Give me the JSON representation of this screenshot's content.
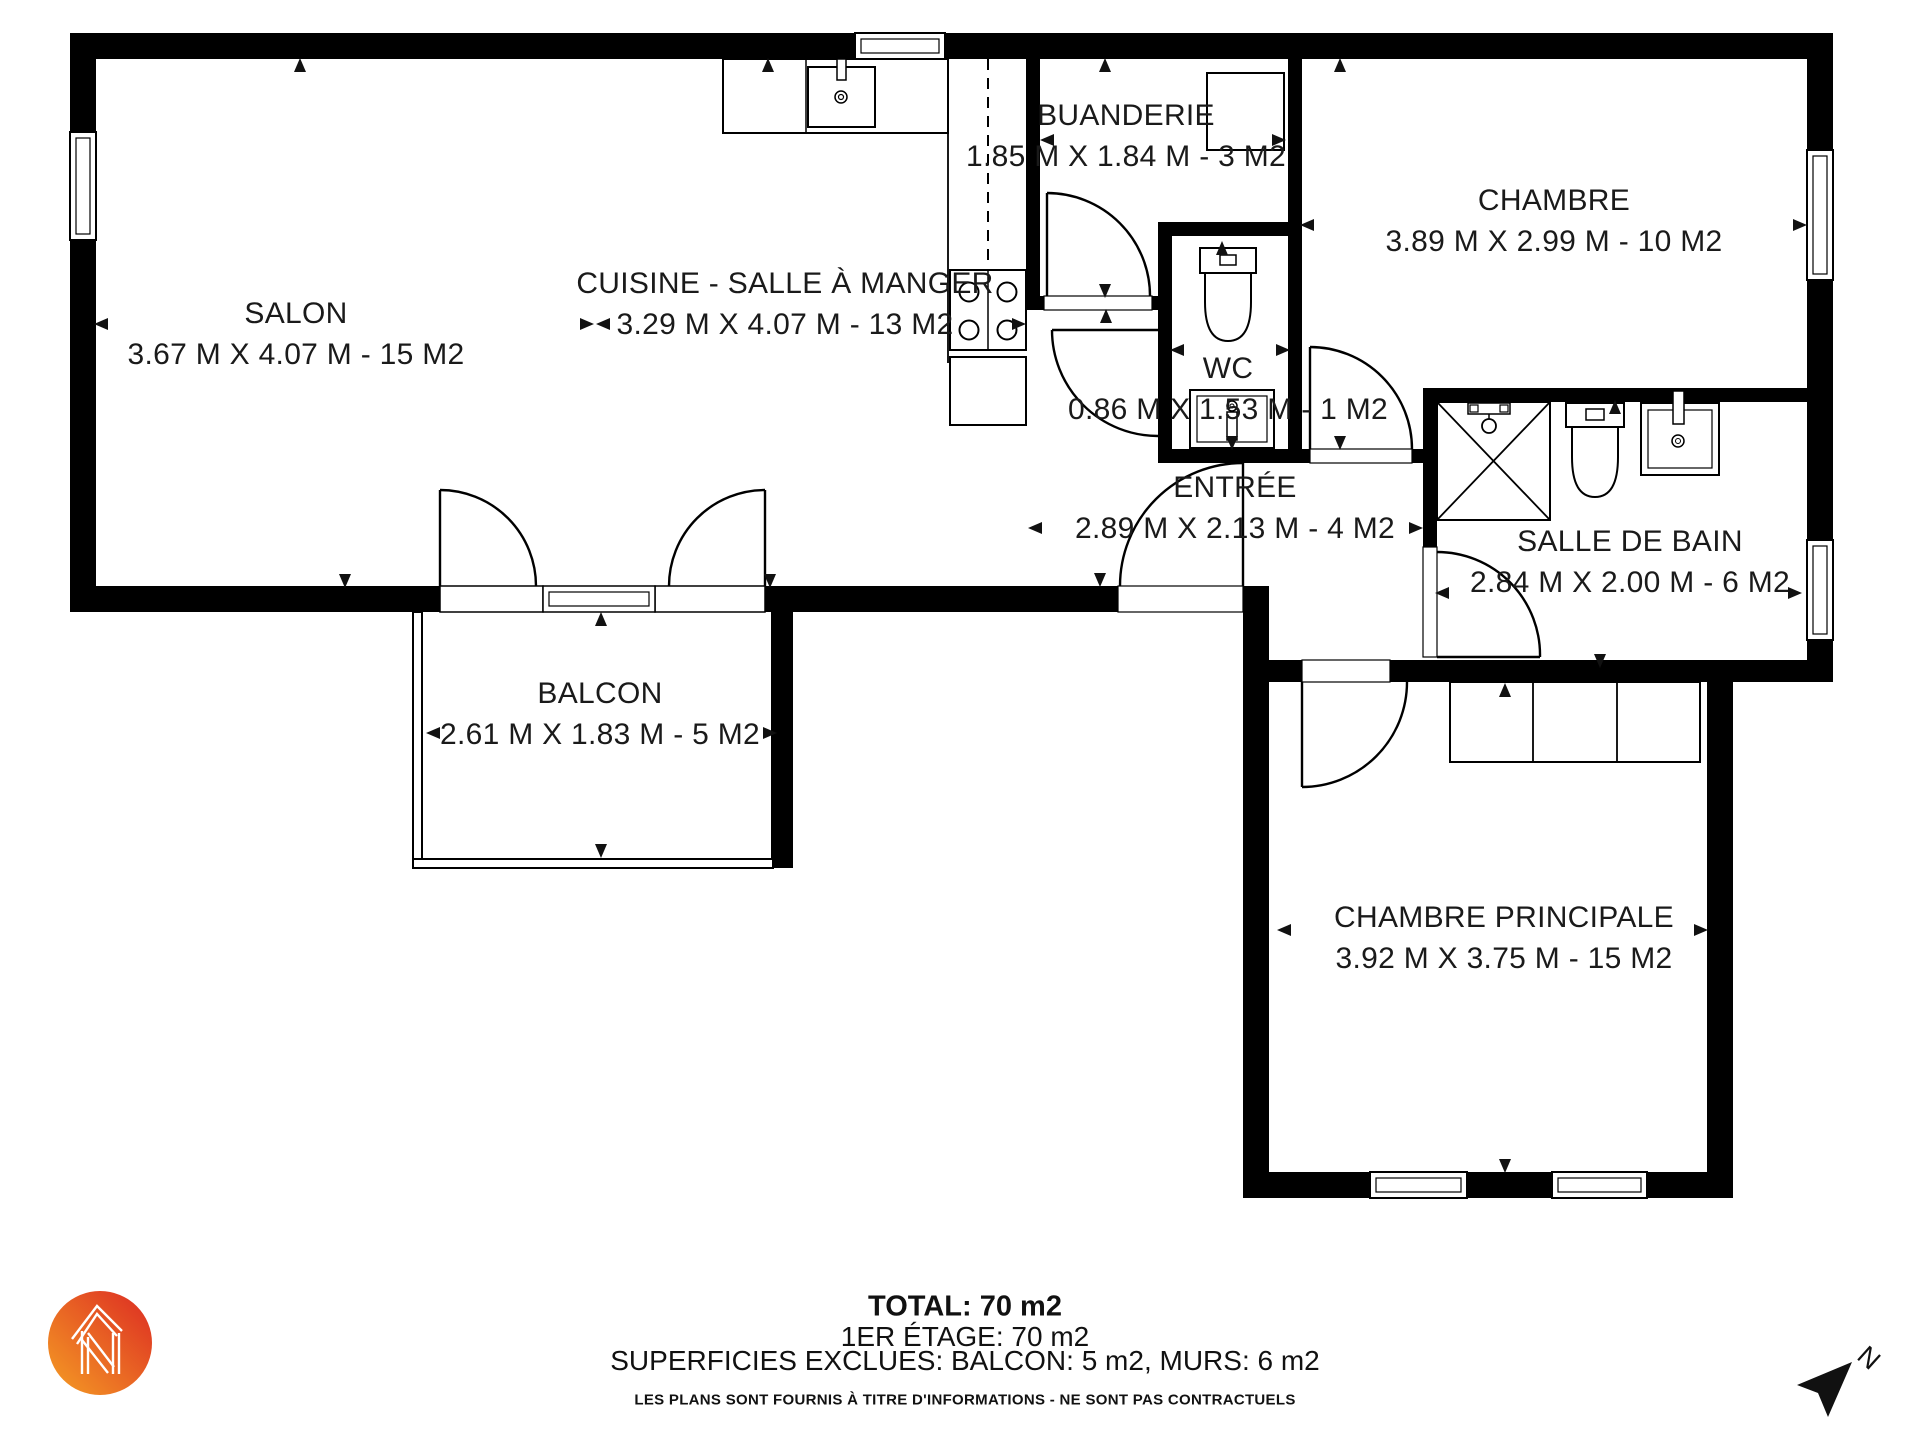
{
  "rooms": [
    {
      "name": "SALON",
      "dims": "3.67 M X 4.07 M - 15 M2"
    },
    {
      "name": "CUISINE - SALLE À MANGER",
      "dims": "3.29 M X 4.07 M - 13 M2"
    },
    {
      "name": "BUANDERIE",
      "dims": "1.85 M X 1.84 M - 3 M2"
    },
    {
      "name": "CHAMBRE",
      "dims": "3.89 M X 2.99 M - 10 M2"
    },
    {
      "name": "WC",
      "dims": "0.86 M X 1.53 M - 1 M2"
    },
    {
      "name": "ENTRÉE",
      "dims": "2.89 M X 2.13 M - 4 M2"
    },
    {
      "name": "SALLE DE BAIN",
      "dims": "2.84 M X 2.00 M - 6 M2"
    },
    {
      "name": "BALCON",
      "dims": "2.61 M X 1.83 M - 5 M2"
    },
    {
      "name": "CHAMBRE PRINCIPALE",
      "dims": "3.92 M X 3.75 M - 15 M2"
    }
  ],
  "footer": {
    "total": "TOTAL: 70 m2",
    "floor": "1ER ÉTAGE: 70 m2",
    "exclusions": "SUPERFICIES EXCLUES: BALCON: 5 m2, MURS: 6 m2",
    "disclaimer": "LES PLANS SONT FOURNIS À TITRE D'INFORMATIONS - NE SONT PAS CONTRACTUELS"
  },
  "compass": {
    "label": "N"
  },
  "colors": {
    "wall": "#000000",
    "text": "#1a1a1a",
    "logo_orange": "#F59E24",
    "logo_red": "#DC2A23"
  }
}
